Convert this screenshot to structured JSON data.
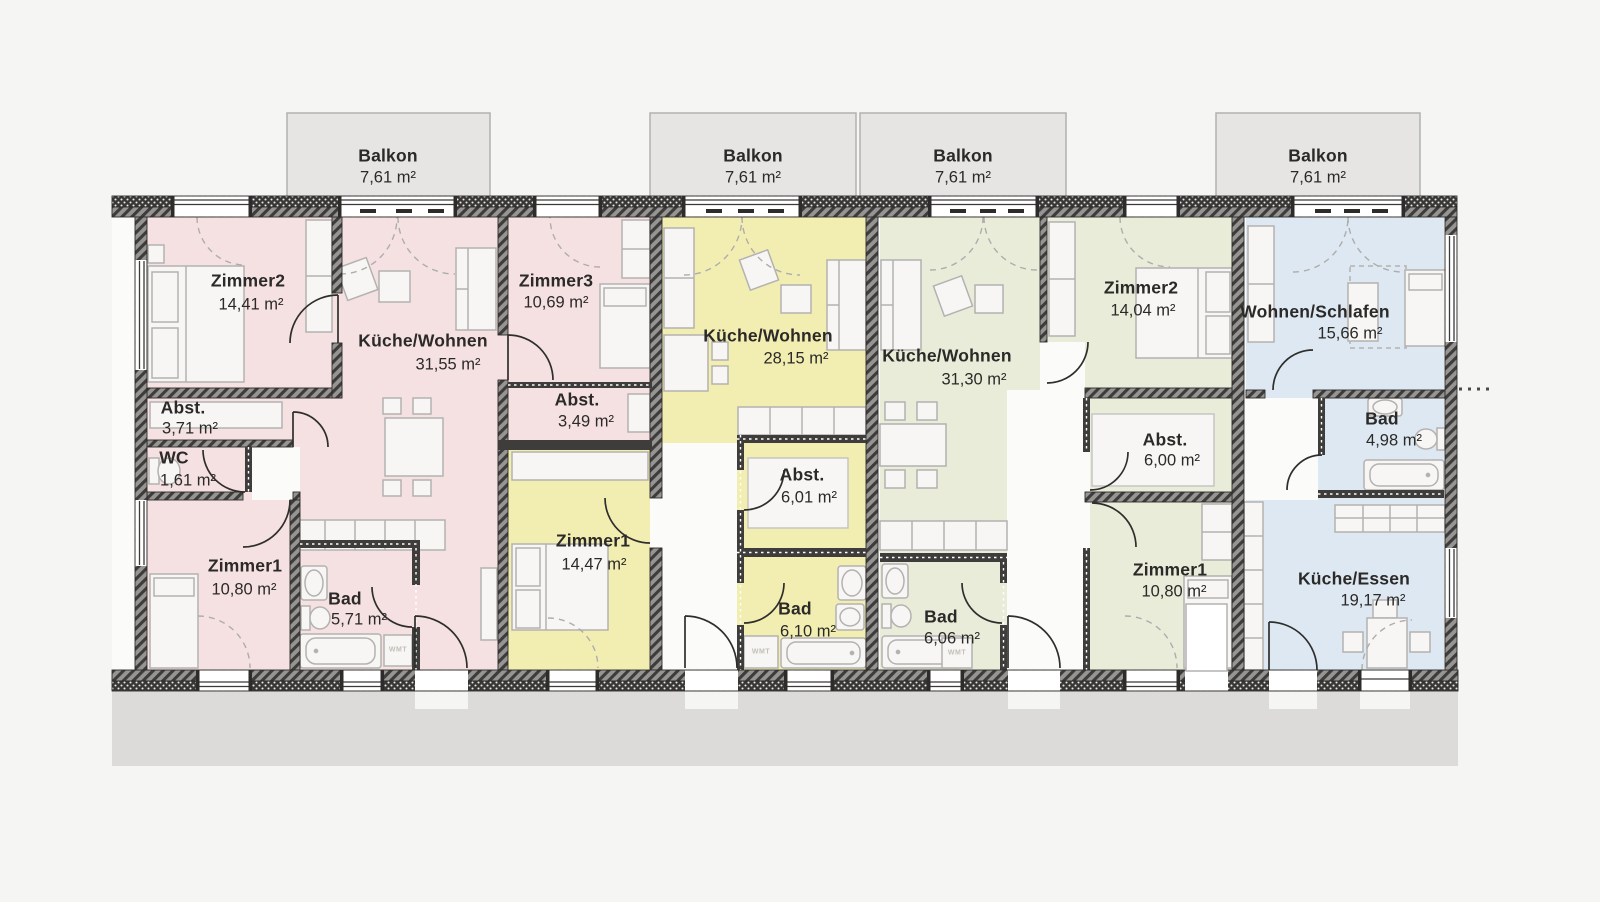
{
  "balconies": [
    {
      "label": "Balkon",
      "area": "7,61 m²"
    },
    {
      "label": "Balkon",
      "area": "7,61 m²"
    },
    {
      "label": "Balkon",
      "area": "7,61 m²"
    },
    {
      "label": "Balkon",
      "area": "7,61 m²"
    }
  ],
  "apartments": [
    {
      "name": "apartment-1-pink",
      "color": "#f5e1e2",
      "rooms": [
        {
          "label": "Zimmer2",
          "area": "14,41 m²"
        },
        {
          "label": "Küche/Wohnen",
          "area": "31,55 m²"
        },
        {
          "label": "Zimmer3",
          "area": "10,69 m²"
        },
        {
          "label": "Abst.",
          "area": "3,71 m²"
        },
        {
          "label": "WC",
          "area": "1,61 m²"
        },
        {
          "label": "Zimmer1",
          "area": "10,80 m²"
        },
        {
          "label": "Bad",
          "area": "5,71 m²"
        },
        {
          "label": "Abst.",
          "area": "3,49 m²"
        }
      ]
    },
    {
      "name": "apartment-2-yellow",
      "color": "#f2eeb2",
      "rooms": [
        {
          "label": "Küche/Wohnen",
          "area": "28,15 m²"
        },
        {
          "label": "Abst.",
          "area": "6,01 m²"
        },
        {
          "label": "Zimmer1",
          "area": "14,47 m²"
        },
        {
          "label": "Bad",
          "area": "6,10 m²"
        }
      ]
    },
    {
      "name": "apartment-3-green",
      "color": "#e9ecd9",
      "rooms": [
        {
          "label": "Küche/Wohnen",
          "area": "31,30 m²"
        },
        {
          "label": "Zimmer2",
          "area": "14,04 m²"
        },
        {
          "label": "Abst.",
          "area": "6,00 m²"
        },
        {
          "label": "Zimmer1",
          "area": "10,80 m²"
        },
        {
          "label": "Bad",
          "area": "6,06 m²"
        }
      ]
    },
    {
      "name": "apartment-4-blue",
      "color": "#dde8f2",
      "rooms": [
        {
          "label": "Wohnen/Schlafen",
          "area": "15,66 m²"
        },
        {
          "label": "Bad",
          "area": "4,98 m²"
        },
        {
          "label": "Küche/Essen",
          "area": "19,17 m²"
        }
      ]
    }
  ],
  "appliances": {
    "washer_label": "WMT"
  }
}
